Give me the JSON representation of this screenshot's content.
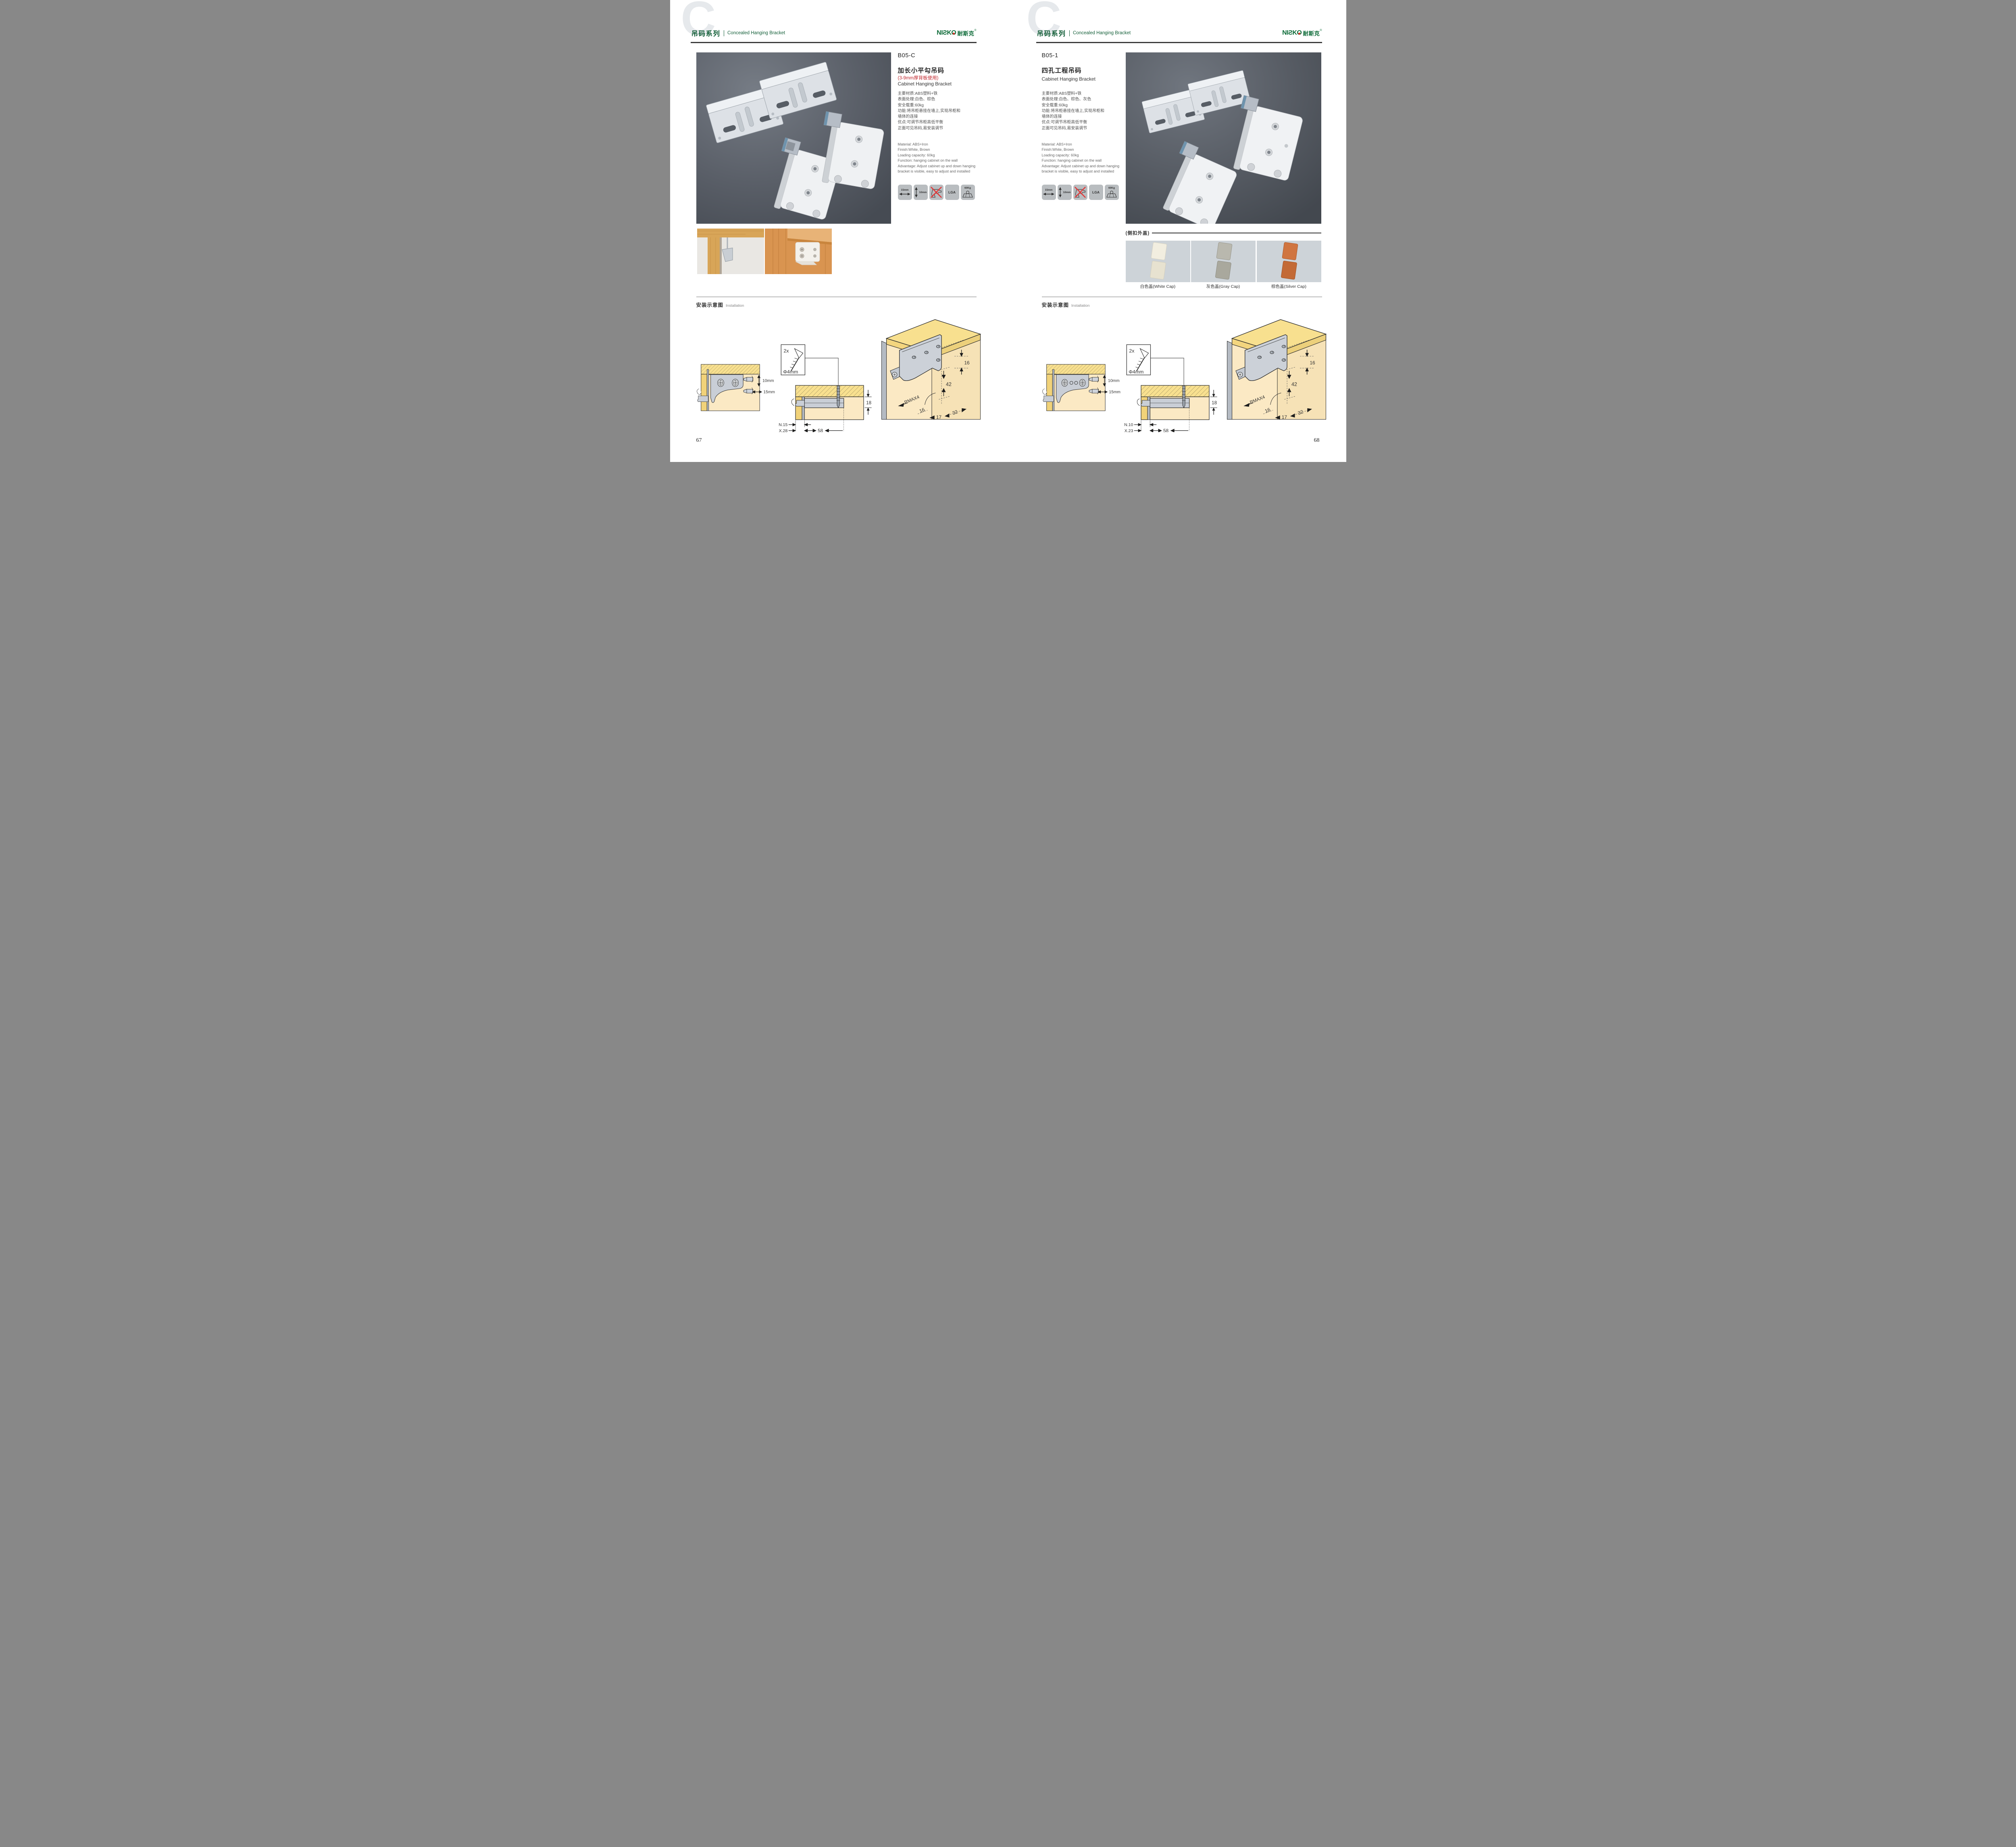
{
  "colors": {
    "brand_green": "#15603a",
    "accent_red": "#c1272d",
    "photo_bg": "#565b63",
    "icon_tile": "#b9bdc0",
    "cap_tile_bg": "#cdd3d8"
  },
  "header": {
    "watermark_letter": "C",
    "series_cn": "吊码系列",
    "series_en": "Concealed Hanging Bracket",
    "brand_latin_left": "NIƧK",
    "brand_latin_o": "O",
    "brand_cn": "耐斯克",
    "brand_reg": "®"
  },
  "icons": {
    "width_label": "15mm",
    "height_label": "10mm",
    "no_drill": "no-drill",
    "cert_label": "LGA",
    "load_label": "60Kg"
  },
  "install": {
    "title_cn": "安装示意图",
    "title_en": "Installation"
  },
  "page67": {
    "page_number": "67",
    "code": "B05-C",
    "name_cn": "加长小平勾吊码",
    "note": "(3-9mm厚背板使用)",
    "name_en": "Cabinet Hanging Bracket",
    "specs_cn": [
      "主要材质:ABS塑料+铁",
      "表面处理:白色、棕色",
      "安全载重:60kg",
      "功能:将吊柜悬挂在墙上,实现吊柜和",
      "墙体的连接",
      "优点:可调节吊柜高低平衡",
      "正面可见吊码,易安装调节"
    ],
    "specs_en": [
      "Material: ABS+Iron",
      "Finish:White, Brown",
      "Loading capacity: 60kg",
      "Function: hanging cabinet on the wall",
      "Advantage: Adjust cabinet up and down hanging",
      "bracket is visible, easy to adjust and installed"
    ],
    "diagram1": {
      "dim_top": "10mm",
      "dim_bottom": "15mm"
    },
    "diagram2": {
      "qty": "2x",
      "dia": "Φ4mm",
      "height": "18",
      "min": "MIN.15",
      "max": "MAX.28",
      "depth": "58"
    },
    "diagram3": {
      "top": "16",
      "mid": "42",
      "radius": "RMAX4",
      "left": "16",
      "front": "17",
      "side": "32"
    }
  },
  "page68": {
    "page_number": "68",
    "code": "B05-1",
    "name_cn": "四孔工程吊码",
    "name_en": "Cabinet Hanging Bracket",
    "specs_cn": [
      "主要材质:ABS塑料+铁",
      "表面处理:白色、棕色、灰色",
      "安全载重:60kg",
      "功能:将吊柜悬挂在墙上,实现吊柜和",
      "墙体的连接",
      "优点:可调节吊柜高低平衡",
      "正面可见吊码,易安装调节"
    ],
    "specs_en": [
      "Material: ABS+Iron",
      "Finish:White, Brown",
      "Loading capacity: 60kg",
      "Function: hanging cabinet on the wall",
      "Advantage: Adjust cabinet up and down hanging",
      "bracket is visible, easy to adjust and installed"
    ],
    "caps": {
      "section_label": "(侧扣外盖)",
      "items": [
        "白色盖(White Cap)",
        "灰色盖(Gray Cap)",
        "棕色盖(Silver Cap)"
      ]
    },
    "diagram1": {
      "dim_top": "10mm",
      "dim_bottom": "15mm"
    },
    "diagram2": {
      "qty": "2x",
      "dia": "Φ4mm",
      "height": "18",
      "min": "MIN.10",
      "max": "MAX.23",
      "depth": "58"
    },
    "diagram3": {
      "top": "16",
      "mid": "42",
      "radius": "RMAX4",
      "left": "16",
      "front": "17",
      "side": "32"
    }
  }
}
